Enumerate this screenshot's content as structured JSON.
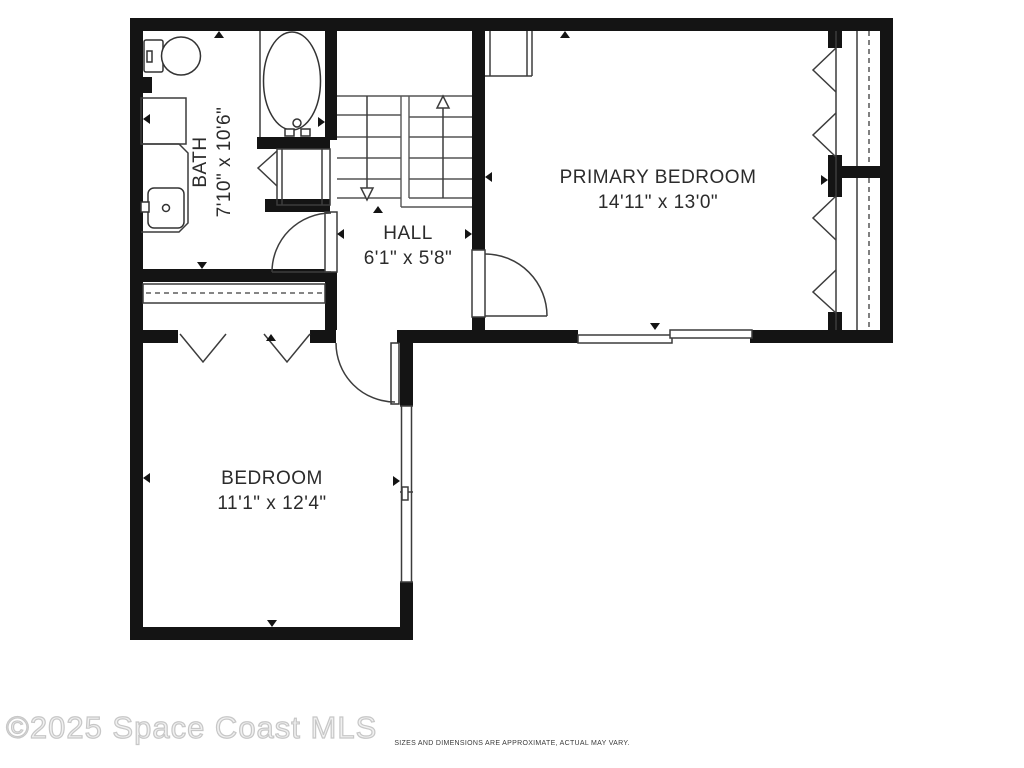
{
  "plan": {
    "rooms": [
      {
        "name": "BATH",
        "dims": "7'10\" x 10'6\""
      },
      {
        "name": "HALL",
        "dims": "6'1\" x 5'8\""
      },
      {
        "name": "PRIMARY BEDROOM",
        "dims": "14'11\" x 13'0\""
      },
      {
        "name": "BEDROOM",
        "dims": "11'1\" x 12'4\""
      }
    ],
    "fixtures": [
      "toilet",
      "bathtub",
      "vanity-sink",
      "linen-closet",
      "stairs-up",
      "stairs-down"
    ],
    "features": [
      "bifold-closet-doors",
      "sliding-door",
      "swing-doors",
      "windows"
    ]
  },
  "footer": {
    "watermark": "©2025 Space Coast MLS",
    "disclaimer": "SIZES AND DIMENSIONS ARE APPROXIMATE, ACTUAL MAY VARY."
  },
  "colors": {
    "wall": "#141414",
    "line": "#3c3c3c",
    "background": "#ffffff",
    "label": "#2b2b2b",
    "watermark": "#f0f0f0"
  }
}
